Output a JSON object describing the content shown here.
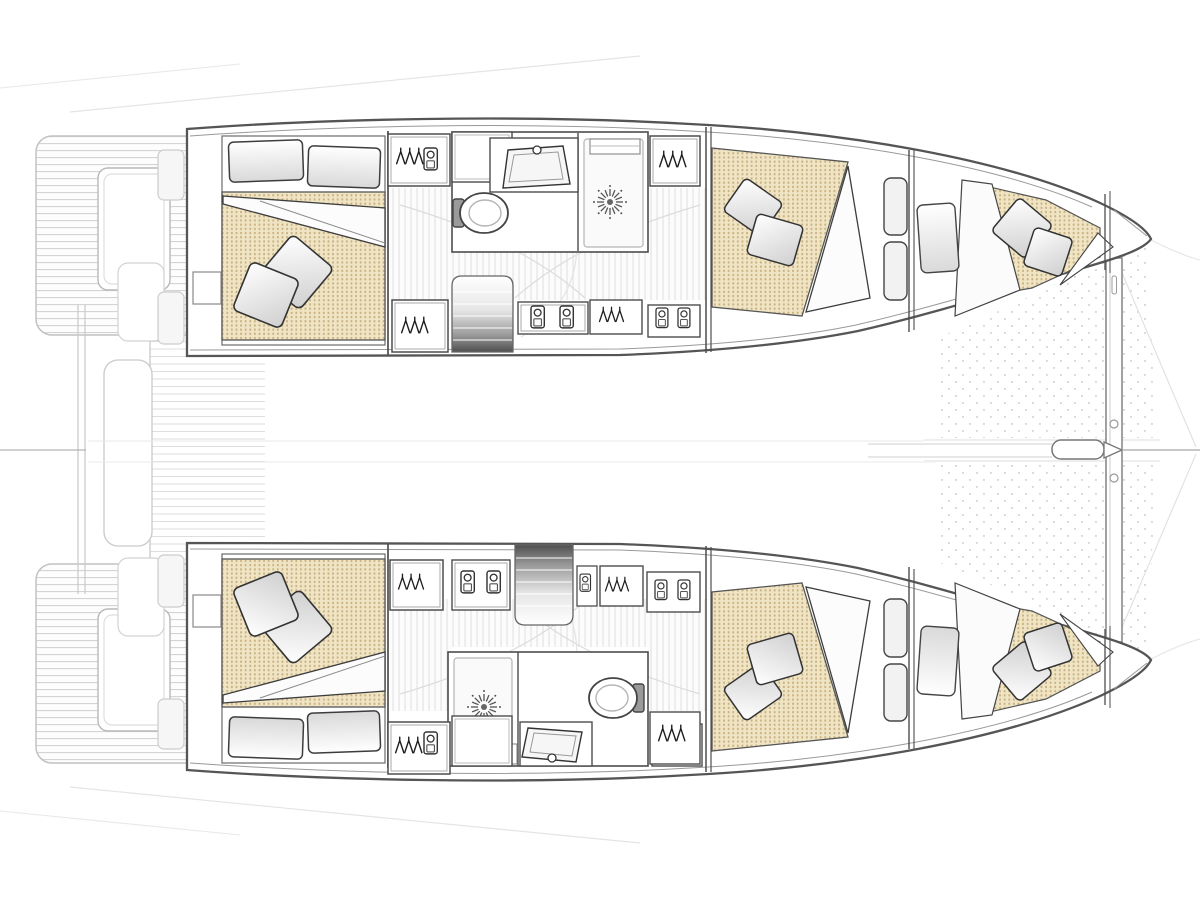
{
  "diagram": {
    "type": "boat-floor-plan",
    "vessel": "sailing catamaran",
    "view": "top-down interior layout of both hulls",
    "stats": {
      "double_cabins": 4,
      "bow_berths": 2,
      "heads_with_shower": 2,
      "companionways": 2
    },
    "hulls": [
      {
        "name": "port-hull-top",
        "rooms": [
          "aft double cabin",
          "head with WC, sink and shower",
          "companionway stairs",
          "wardrobes and shelf lockers",
          "forward double cabin",
          "bow berth"
        ]
      },
      {
        "name": "starboard-hull-bottom",
        "rooms": [
          "aft double cabin",
          "head with WC, sink and shower",
          "companionway stairs",
          "wardrobes and shelf lockers",
          "forward double cabin",
          "bow berth"
        ]
      }
    ],
    "shared_features": [
      "stern swim platforms",
      "central boarding walkway",
      "transom steps",
      "bow trampoline",
      "bowsprit with bridle lines",
      "forward crossbeam"
    ]
  },
  "legend": {
    "hanger-icon": "hanging wardrobe / closet",
    "jar-icon": "shelf locker / storage",
    "starburst-icon": "shower drain",
    "oval-icon": "marine WC (toilet)",
    "basin-icon": "washbasin with faucet",
    "gradient-block": "companionway stairs down into hull",
    "dotted-beige": "berth mattress",
    "dotted-grid": "bow trampoline netting"
  },
  "palette": {
    "background": "#ffffff",
    "hull_line": "#555555",
    "wall_line": "#4d4d4d",
    "furniture_line": "#333333",
    "faint_line": "#cccccc",
    "mattress_base": "#efe4c3",
    "mattress_dot": "#c8ae7e",
    "trampoline_dot": "#d9d9d4",
    "stairs_dark": "#4f4f4f",
    "stairs_light": "#ffffff",
    "pillow_shade": "#cfcfcf",
    "shower_floor": "#fafafa"
  }
}
